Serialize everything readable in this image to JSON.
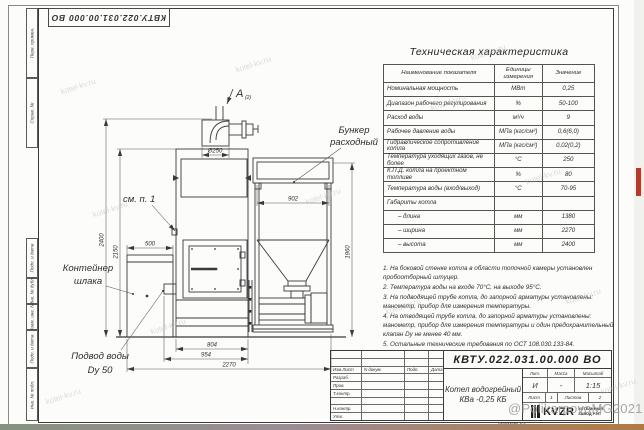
{
  "frame": {
    "doc_number": "КВТУ.022.031.00.000 ВО",
    "left_labels": [
      "Перв. примен.",
      "Справ. №",
      "Подп. и дата",
      "Инв. № дубл.",
      "Взам. инв. №",
      "Подп. и дата",
      "Инв. № подл."
    ],
    "format_label": "Формат А3"
  },
  "spec_table": {
    "title": "Техническая характеристика",
    "headers": [
      "Наименование показателя",
      "Единицы измерения",
      "Значение"
    ],
    "rows": [
      {
        "name": "Номинальная мощность",
        "unit": "МВт",
        "value": "0,25"
      },
      {
        "name": "Диапазон рабочего регулирования",
        "unit": "%",
        "value": "50-100"
      },
      {
        "name": "Расход воды",
        "unit": "м³/ч",
        "value": "9"
      },
      {
        "name": "Рабочее давление воды",
        "unit": "МПа (кгс/см²)",
        "value": "0,6(6,0)"
      },
      {
        "name": "Гидравлическое сопротивление котла",
        "unit": "МПа (кгс/см²)",
        "value": "0,02(0,2)"
      },
      {
        "name": "Температура уходящих газов, не более",
        "unit": "°С",
        "value": "250"
      },
      {
        "name": "К.П.Д. котла на проектном топливе",
        "unit": "%",
        "value": "80"
      },
      {
        "name": "Температура воды (вход/выход)",
        "unit": "°С",
        "value": "70-95"
      },
      {
        "name": "Габариты котла",
        "unit": "",
        "value": ""
      },
      {
        "name": "– длина",
        "unit": "мм",
        "value": "1380",
        "indent": true
      },
      {
        "name": "– ширина",
        "unit": "мм",
        "value": "2270",
        "indent": true
      },
      {
        "name": "– высота",
        "unit": "мм",
        "value": "2400",
        "indent": true
      }
    ]
  },
  "notes": [
    "1. На боковой стенке котла в области топочной камеры установлен пробоотборный штуцер.",
    "2. Температура воды на входе 70°С, на выходе 95°С.",
    "3. На подводящей трубе котла, до запорной арматуры установлены: манометр, прибор для измерения температуры.",
    "4. На отводящей трубе котла, до запорной арматуры установлены: манометр, прибор для измерения температуры и один предохранительный клапан Dу не менее 40 мм.",
    "5. Остальные технические требования по ОСТ 108.030.133-84."
  ],
  "drawing": {
    "dims": {
      "d500": "500",
      "d250": "Ø250",
      "d902": "902",
      "d804": "804",
      "d954": "954",
      "d2270": "2270",
      "d2400": "2400",
      "d2150": "2150",
      "d1960": "1960"
    },
    "labels": {
      "view": "А",
      "view_sheet": "(2)",
      "bunker1": "Бункер",
      "bunker2": "расходный",
      "see_note": "см. п. 1",
      "slag1": "Контейнер",
      "slag2": "шлака",
      "water1": "Подвод воды",
      "water2": "Dу 50"
    }
  },
  "title_block": {
    "doc_number": "КВТУ.022.031.00.000 ВО",
    "cols": [
      "Изм.Лист",
      "N докум.",
      "Подп.",
      "Дата"
    ],
    "row_labels": [
      "Разраб.",
      "Пров.",
      "Т.контр.",
      "",
      "Н.контр.",
      "Утв."
    ],
    "name_line1": "Котел водогрейный",
    "name_line2": "КВа -0,25 КБ",
    "lit_label": "Лит.",
    "mass_label": "Масса",
    "scale_label": "Масштаб",
    "lit": "И",
    "mass": "-",
    "scale": "1:15",
    "sheet_label": "Лист",
    "sheet_no": "1",
    "sheets_label": "Листов",
    "sheets_no": "2",
    "logo_text": "KVZR",
    "logo_sub1": "КОТЕЛЬНЫЙ",
    "logo_sub2": "ЗАВОД РЭП"
  },
  "watermark": {
    "tile": "kotel-kv.ru",
    "credit": "@PolikarpovaMG2021"
  },
  "colors": {
    "line": "#3a3a3a",
    "thin_line": "#55544f",
    "paper": "#fcfcfa",
    "red_marker": "#b23b2e",
    "credit_gray": "#98989a"
  }
}
